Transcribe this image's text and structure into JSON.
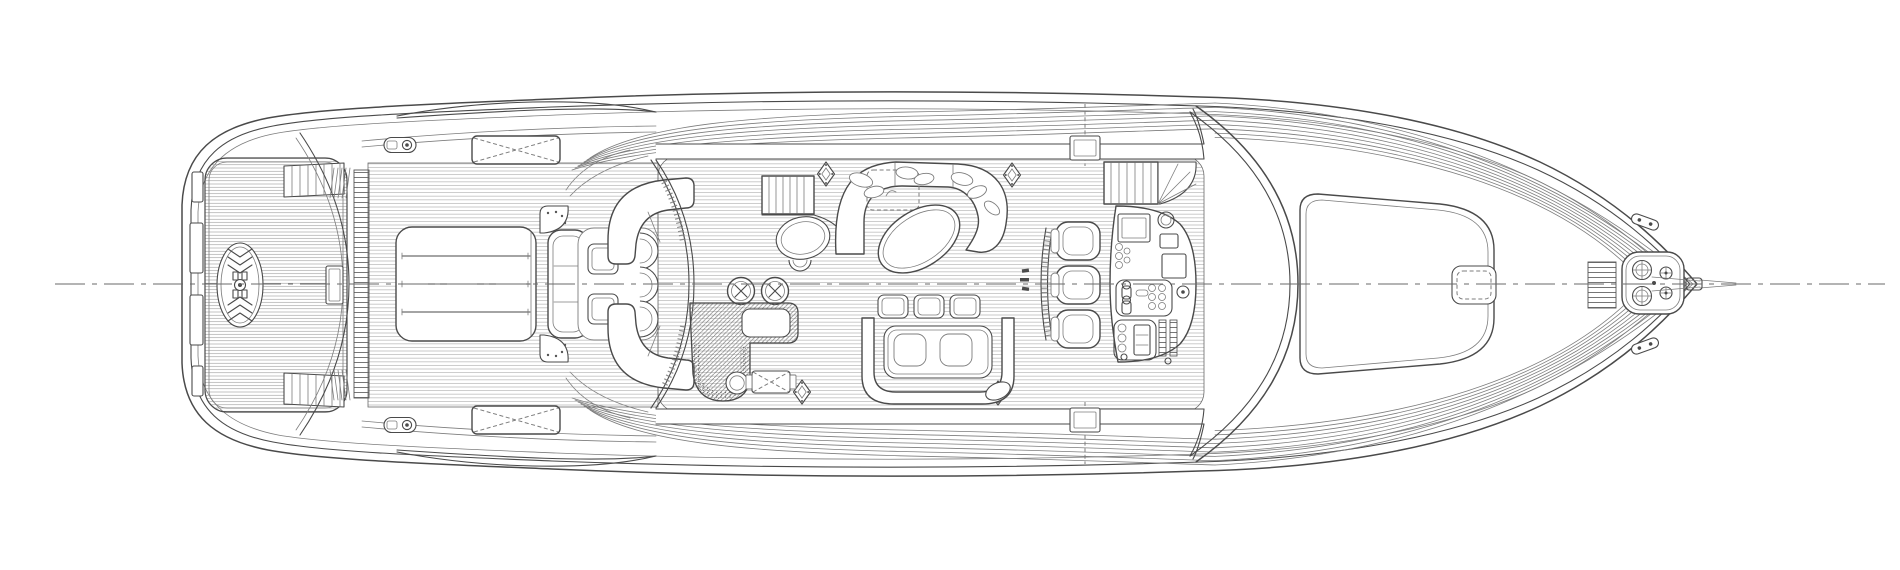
{
  "meta": {
    "description": "Technical line drawing: motor yacht main deck general arrangement plan, top view, bow facing right, black ink on white paper",
    "colors": {
      "paper": "#ffffff",
      "line": "#4a4a4a",
      "line_soft": "#7d7d7d",
      "plank_line": "#a0a0a0",
      "annotation_dark": "#2e2e2e"
    },
    "centerline_style": "dash-dot, full length of vessel"
  },
  "components": {
    "stern": [
      "swim-platform with teak planking",
      "herringbone transom medallion",
      "port and starboard boarding steps",
      "transom garage hatch ladder",
      "centerline transom box"
    ],
    "aft_deck": [
      "large sunpad with three cushion seams",
      "perforated corner fans",
      "aft-facing bench sofa",
      "two square cocktail tables",
      "three crescent chairs",
      "port and starboard quarter-round settees",
      "liferaft lockers with dashed X",
      "mooring cleats"
    ],
    "salon": [
      "curved sliding-door bulkhead with track hatching",
      "port staircase",
      "side oval table with crescent chair",
      "horseshoe lounge sofa with scatter pillows",
      "dashed table footprint",
      "angled oval coffee table",
      "two round bar stools with star tops",
      "L-shaped bar with hatched counter, stippled rim and sink",
      "engine-room hatch with dashed X",
      "four diamond vent rosettes",
      "starboard dinette: three ottomans, U-sofa, table with two cushions, small oval stool"
    ],
    "helm": [
      "three bucket helm seats",
      "curved footrest rail",
      "instrument console pod with screens, gauges, throttles, wheel and trim bars",
      "starboard companionway stairs with fan landing",
      "tiny illegible annotation near centerline"
    ],
    "foredeck": [
      "wraparound windshield",
      "large rounded deck hatch",
      "small skylight hatch with dashed inner frame",
      "ribbed deck strip",
      "anchor windlass pod with two drum winches and two capstans",
      "angled bow cleats",
      "anchor roller at stem"
    ],
    "general": [
      "triple sheer lines",
      "curved side-deck plank lines",
      "bulwark gates port and starboard",
      "hardtop lens edge aft",
      "dash-dot centerline"
    ]
  },
  "annotations": {
    "helm_note": "illegible micro-text",
    "visible_text": "none legible"
  }
}
